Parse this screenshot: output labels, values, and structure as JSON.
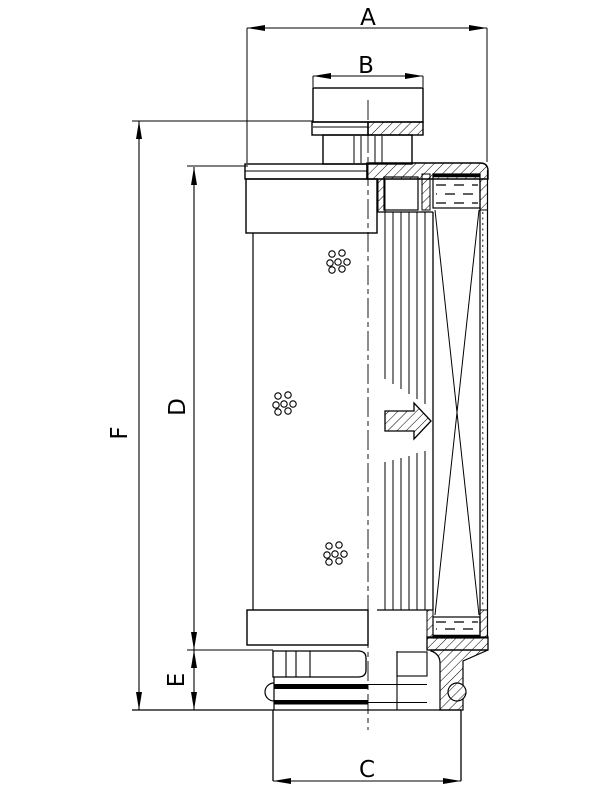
{
  "drawing": {
    "background_color": "#ffffff",
    "line_color": "#000000"
  },
  "dimensions": {
    "a": {
      "label": "A"
    },
    "b": {
      "label": "B"
    },
    "c": {
      "label": "C"
    },
    "d": {
      "label": "D"
    },
    "e": {
      "label": "E"
    },
    "f": {
      "label": "F"
    }
  },
  "symbols": {
    "flow_arrow": "block-arrow-right",
    "hatch_style": "diagonal-45",
    "perforations": "hole-cluster"
  }
}
